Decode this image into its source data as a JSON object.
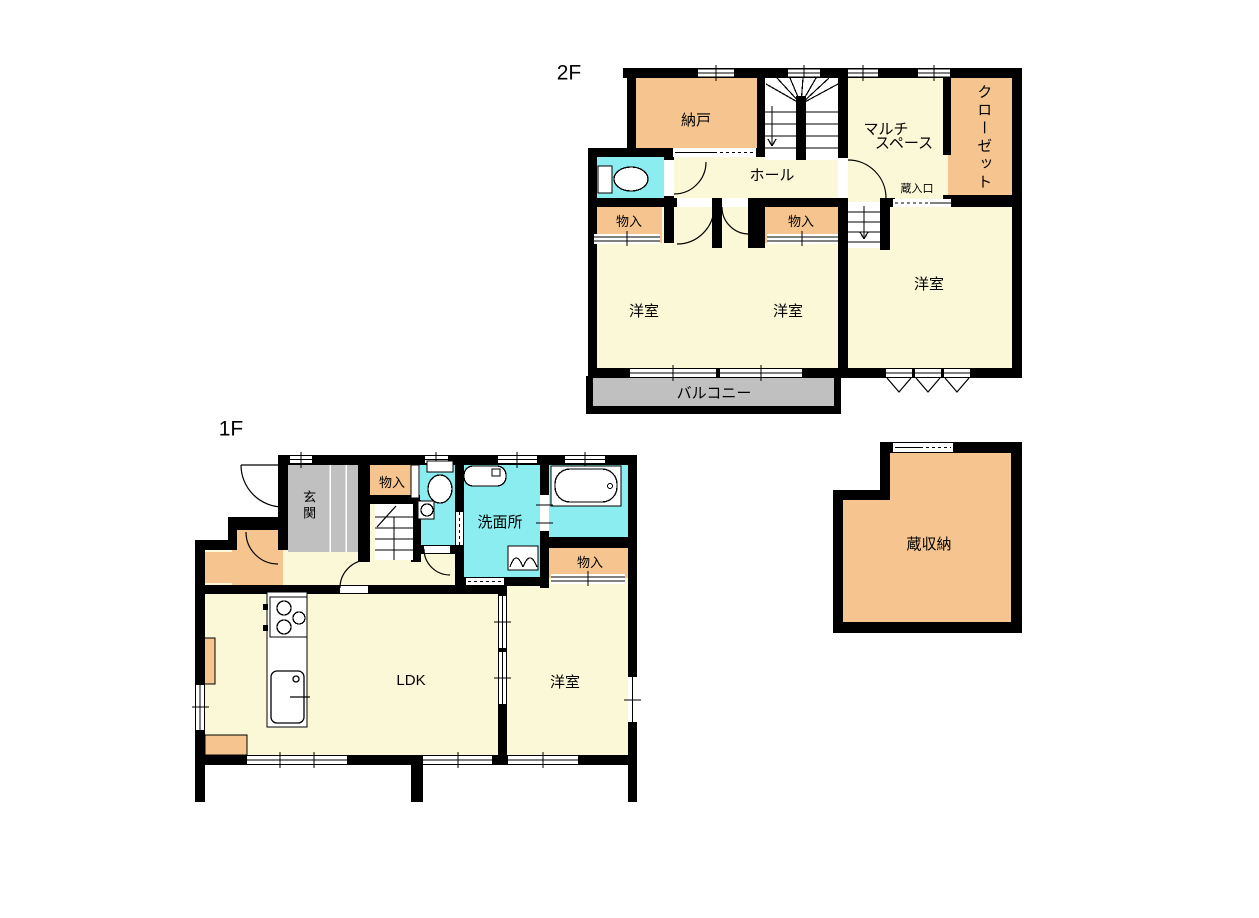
{
  "colors": {
    "wall": "#000000",
    "room": "#FBF8D7",
    "storage": "#F5C48F",
    "wet": "#8BEDF0",
    "gray": "#C0C0C0",
    "bg": "#FFFFFF",
    "line": "#000000"
  },
  "floor2": {
    "label": "2F",
    "nando": "納戸",
    "multi1": "マルチ",
    "multi2": "スペース",
    "closet": "クローゼット",
    "hall": "ホール",
    "kura_entrance": "蔵入口",
    "mono_left": "物入",
    "mono_right": "物入",
    "yoshitsu_left": "洋室",
    "yoshitsu_mid": "洋室",
    "yoshitsu_right": "洋室",
    "balcony": "バルコニー"
  },
  "floor1": {
    "label": "1F",
    "genkan": "玄関",
    "mono_top": "物入",
    "senmenjo": "洗面所",
    "mono_right": "物入",
    "ldk": "LDK",
    "yoshitsu": "洋室"
  },
  "kura": {
    "label": "蔵収納"
  }
}
